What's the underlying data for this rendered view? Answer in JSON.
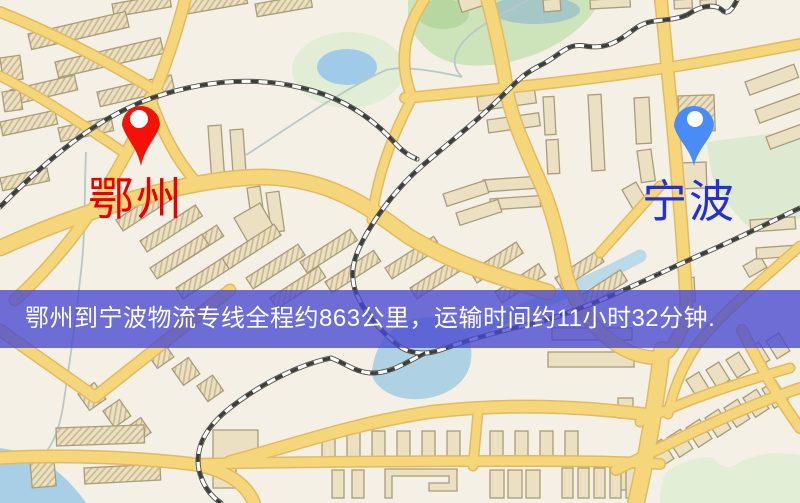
{
  "banner": {
    "text": "鄂州到宁波物流专线全程约863公里，运输时间约11小时32分钟."
  },
  "route": {
    "origin": "鄂州",
    "destination": "宁波",
    "distance": "约863公里",
    "duration": "约11小时32分钟"
  },
  "markers": {
    "origin": {
      "label": "鄂州"
    },
    "destination": {
      "label": "宁波"
    }
  },
  "colors": {
    "map_bg": "#f4f0e6",
    "road_fill": "#f6d67b",
    "road_casing": "#e2ba60",
    "building_fill": "#ece0c2",
    "building_stroke": "#a89c79",
    "water": "#a9cfe6",
    "park": "#cde3b9",
    "banner_bg": "rgba(70,72,208,0.78)",
    "banner_text": "#ffffff",
    "origin_pin": "#f31108",
    "origin_label": "#e60000",
    "destination_pin": "#4a8cf5",
    "destination_label": "#2630d2"
  }
}
